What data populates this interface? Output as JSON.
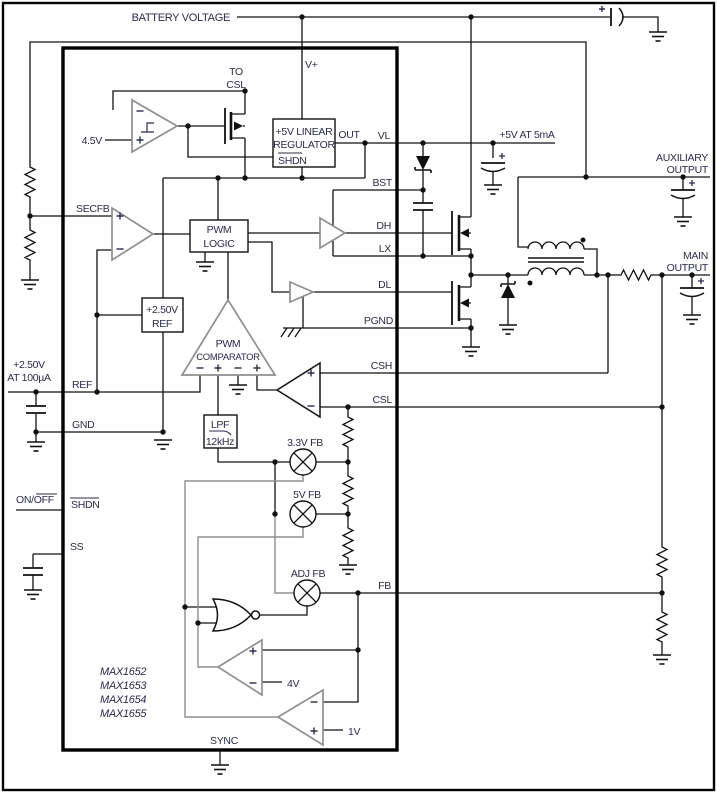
{
  "title": "MAX1652-MAX1655 standard application circuit schematic",
  "colors": {
    "wire": "#111111",
    "text": "#2b2b4d",
    "amp_outline": "#8f8f8f"
  },
  "signs": {
    "plus": "+",
    "minus": "−"
  },
  "labels": {
    "battery_voltage": "BATTERY VOLTAGE",
    "v_plus": "V+",
    "to": "TO",
    "csl_top": "CSL",
    "uvlo_ref": "4.5V",
    "regulator_l1": "+5V LINEAR",
    "regulator_l2": "REGULATOR",
    "regulator_shdn": "SHDN",
    "out": "OUT",
    "five_v_at": "+5V AT 5mA",
    "aux_l1": "AUXILIARY",
    "aux_l2": "OUTPUT",
    "main_l1": "MAIN",
    "main_l2": "OUTPUT",
    "pwm_logic_l1": "PWM",
    "pwm_logic_l2": "LOGIC",
    "ref_box_l1": "+2.50V",
    "ref_box_l2": "REF",
    "pwm_comp_l1": "PWM",
    "pwm_comp_l2": "COMPARATOR",
    "ref_out_l1": "+2.50V",
    "ref_out_l2": "AT 100µA",
    "on_off": "ON/OFF",
    "lpf_l1": "LPF",
    "lpf_l2": "12kHz",
    "fb_33": "3.3V FB",
    "fb_5": "5V FB",
    "fb_adj": "ADJ FB",
    "ref_4v": "4V",
    "ref_1v": "1V",
    "parts": [
      "MAX1652",
      "MAX1653",
      "MAX1654",
      "MAX1655"
    ]
  },
  "pins": {
    "secfb": "SECFB",
    "ref": "REF",
    "gnd": "GND",
    "shdn": "SHDN",
    "ss": "SS",
    "sync": "SYNC",
    "vl": "VL",
    "bst": "BST",
    "dh": "DH",
    "lx": "LX",
    "dl": "DL",
    "pgnd": "PGND",
    "csh": "CSH",
    "csl": "CSL",
    "fb": "FB"
  }
}
